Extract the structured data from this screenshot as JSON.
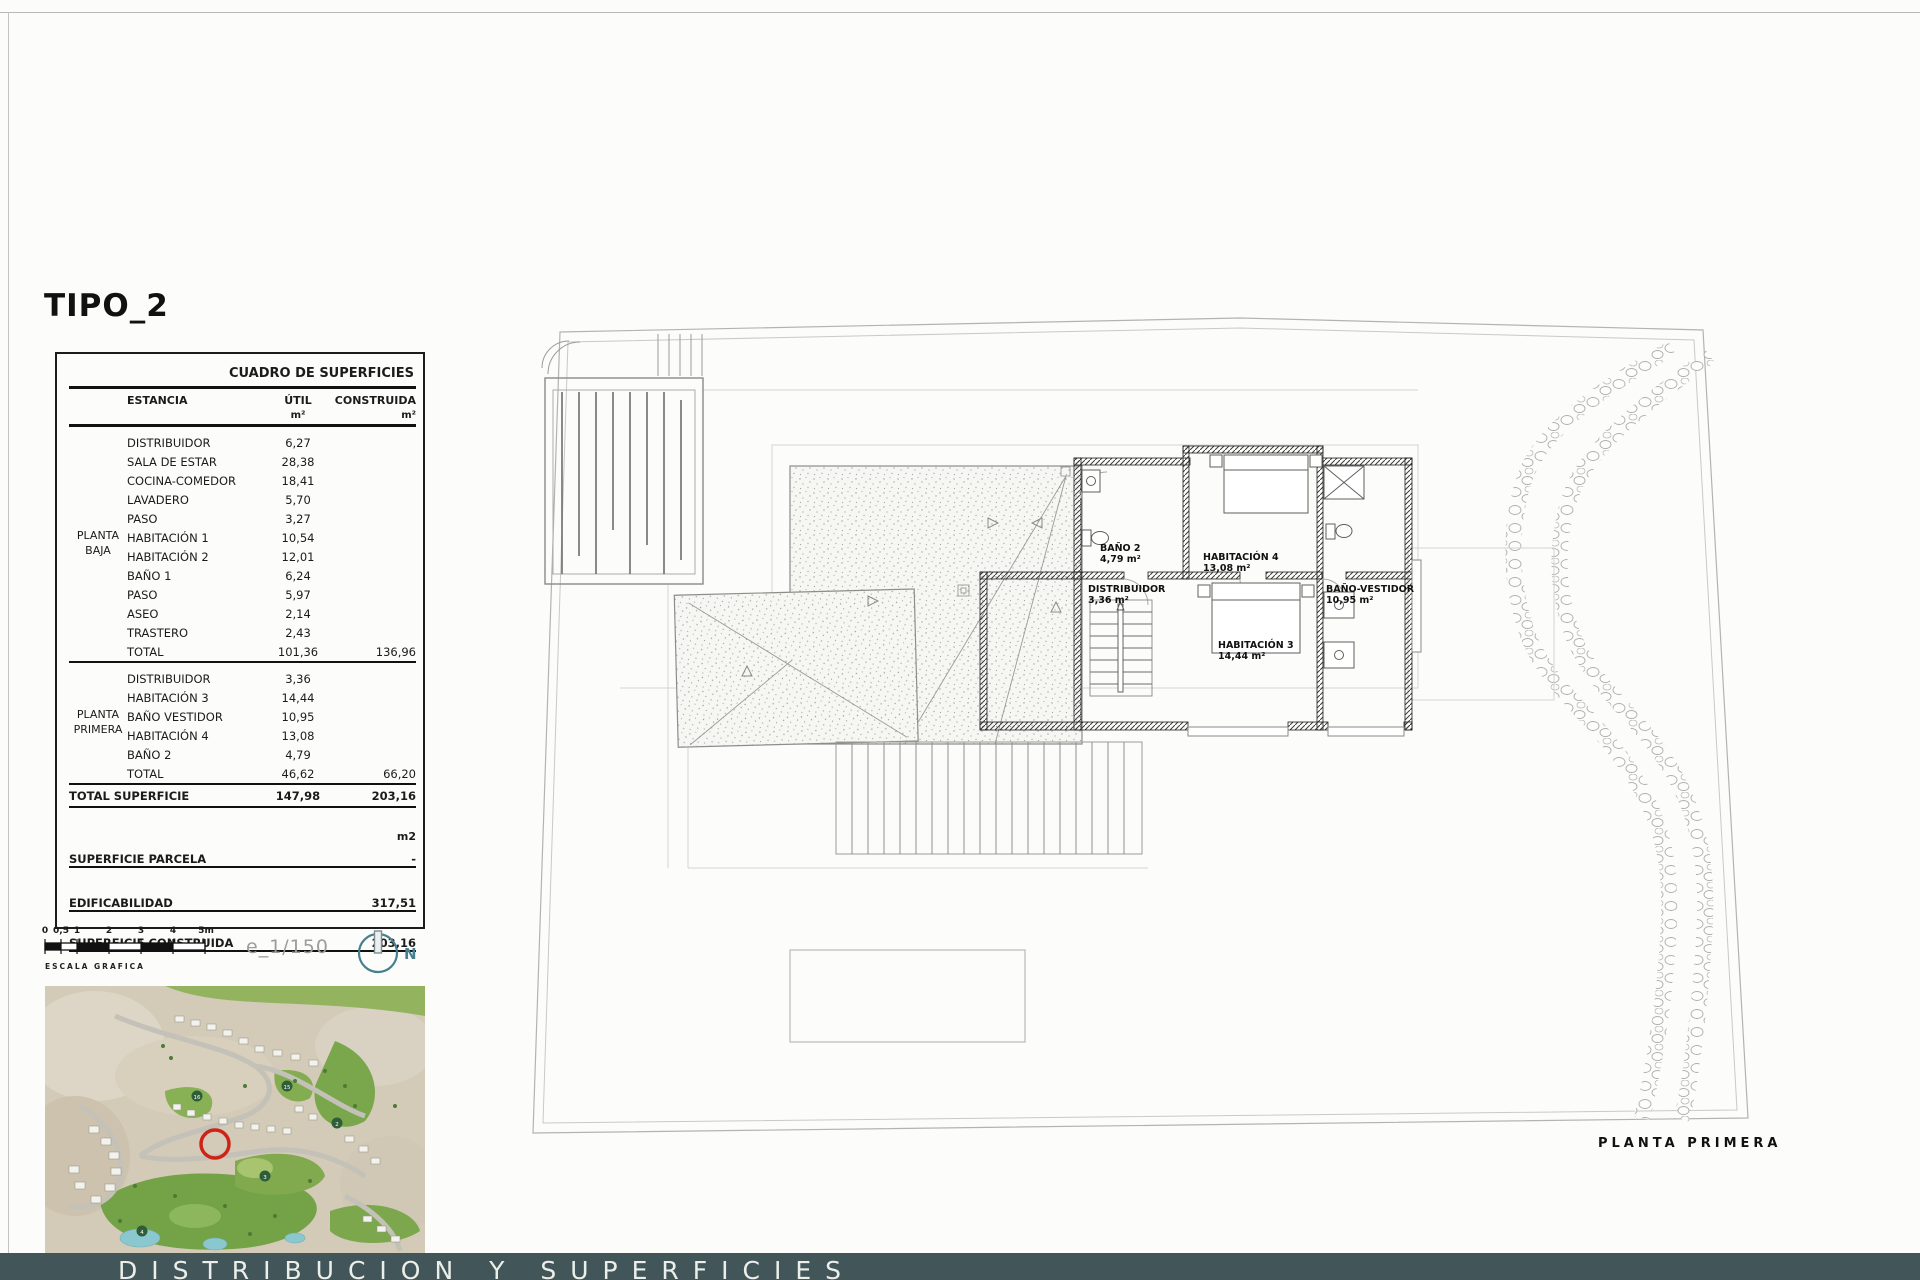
{
  "page": {
    "title": "TIPO_2",
    "scale_text": "e_1/150",
    "north_label": "N",
    "scale_bar": {
      "labels": [
        "0",
        "0,5",
        "1",
        "2",
        "3",
        "4",
        "5m"
      ],
      "caption": "ESCALA GRAFICA"
    },
    "bottom_bar_label": "DISTRIBUCION Y SUPERFICIES"
  },
  "table": {
    "title": "CUADRO DE SUPERFICIES",
    "columns": {
      "estancia": "ESTANCIA",
      "util": "ÚTIL",
      "construida": "CONSTRUIDA",
      "unit": "m²"
    },
    "groups": [
      {
        "label": "PLANTA BAJA",
        "rows": [
          {
            "name": "DISTRIBUIDOR",
            "util": "6,27"
          },
          {
            "name": "SALA DE ESTAR",
            "util": "28,38"
          },
          {
            "name": "COCINA-COMEDOR",
            "util": "18,41"
          },
          {
            "name": "LAVADERO",
            "util": "5,70"
          },
          {
            "name": "PASO",
            "util": "3,27"
          },
          {
            "name": "HABITACIÓN 1",
            "util": "10,54"
          },
          {
            "name": "HABITACIÓN 2",
            "util": "12,01"
          },
          {
            "name": "BAÑO 1",
            "util": "6,24"
          },
          {
            "name": "PASO",
            "util": "5,97"
          },
          {
            "name": "ASEO",
            "util": "2,14"
          },
          {
            "name": "TRASTERO",
            "util": "2,43"
          }
        ],
        "total": {
          "label": "TOTAL",
          "util": "101,36",
          "construida": "136,96"
        }
      },
      {
        "label": "PLANTA PRIMERA",
        "rows": [
          {
            "name": "DISTRIBUIDOR",
            "util": "3,36"
          },
          {
            "name": "HABITACIÓN 3",
            "util": "14,44"
          },
          {
            "name": "BAÑO VESTIDOR",
            "util": "10,95"
          },
          {
            "name": "HABITACIÓN 4",
            "util": "13,08"
          },
          {
            "name": "BAÑO 2",
            "util": "4,79"
          }
        ],
        "total": {
          "label": "TOTAL",
          "util": "46,62",
          "construida": "66,20"
        }
      }
    ],
    "total_superficie": {
      "label": "TOTAL SUPERFICIE",
      "util": "147,98",
      "construida": "203,16"
    },
    "summary": {
      "unit_label": "m2",
      "rows": [
        {
          "label": "SUPERFICIE PARCELA",
          "value": "-"
        },
        {
          "label": "EDIFICABILIDAD",
          "value": "317,51"
        },
        {
          "label": "SUPERFICIE CONSTRUIDA",
          "value": "203,16"
        }
      ]
    }
  },
  "plan": {
    "caption": "PLANTA PRIMERA",
    "rooms": [
      {
        "name": "BAÑO 2",
        "area": "4,79 m²"
      },
      {
        "name": "HABITACIÓN 4",
        "area": "13,08 m²"
      },
      {
        "name": "DISTRIBUIDOR",
        "area": "3,36 m²"
      },
      {
        "name": "BAÑO-VESTIDOR",
        "area": "10,95 m²"
      },
      {
        "name": "HABITACIÓN 3",
        "area": "14,44 m²"
      }
    ]
  },
  "map": {
    "hole_markers": [
      "16",
      "15",
      "2",
      "3",
      "4"
    ]
  },
  "colors": {
    "accent_teal": "#46808e",
    "bottom_bar_bg": "#42565a",
    "marker_red": "#cf2318"
  }
}
